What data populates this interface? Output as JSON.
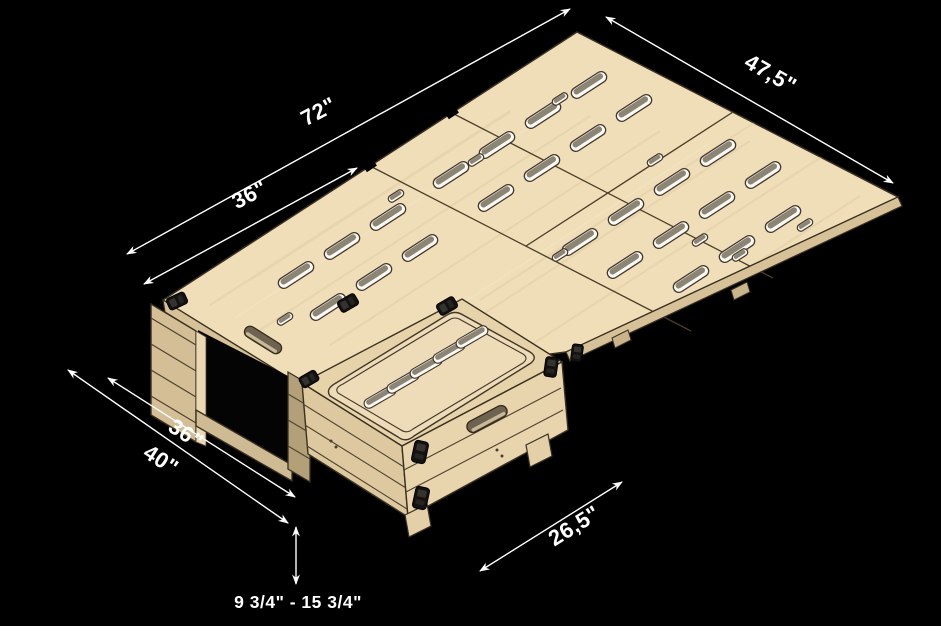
{
  "dims": {
    "platform_length": "72\"",
    "platform_left_section": "36\"",
    "platform_width": "47,5\"",
    "base_width_inner": "36\"",
    "base_width_outer": "40\"",
    "box_depth": "26,5\"",
    "height_range": "9 3/4\" - 15 3/4\""
  },
  "colors": {
    "background": "#000000",
    "annotation": "#ffffff",
    "wood_top": "#efdeb8",
    "wood_grain": "#dcc49c",
    "wood_edge": "#d6c199",
    "wood_side_light": "#e8d5ad",
    "wood_side_mid": "#d3be96",
    "wood_side_dark": "#b3a078",
    "outline": "#3a3020",
    "slot_wall": "#8d8574",
    "slot_face": "#fbfaf6",
    "clip": "#141210"
  }
}
